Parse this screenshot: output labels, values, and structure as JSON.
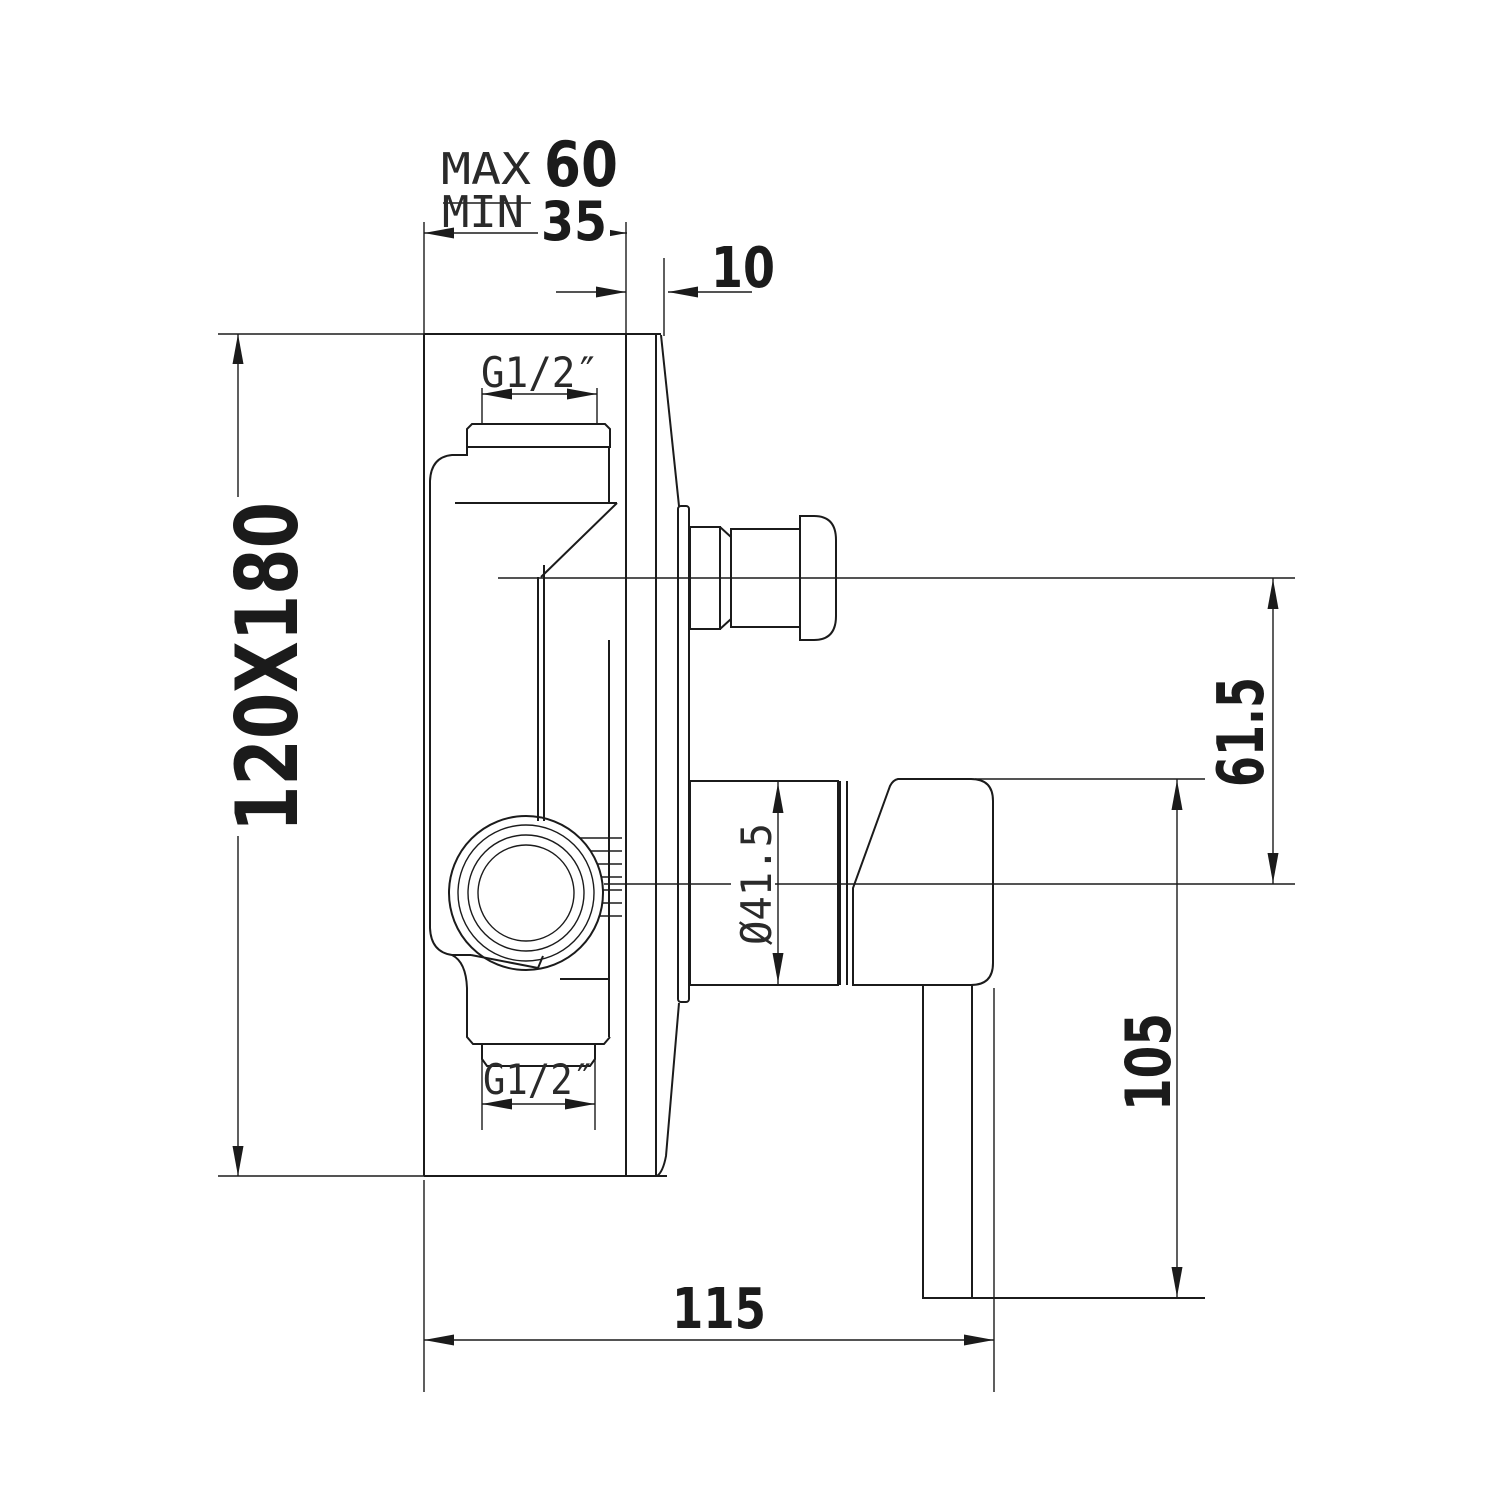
{
  "drawing": {
    "type": "technical-drawing",
    "subject": "concealed shower mixer valve side section",
    "colors": {
      "ink": "#1b1b1b",
      "background": "#ffffff"
    },
    "labels": {
      "max_label": "MAX",
      "max_value": "60",
      "min_label": "MIN",
      "min_value": "35",
      "plaster_depth": "10",
      "plate_size": "120X180",
      "thread_top": "G1/2″",
      "thread_bottom": "G1/2″",
      "outlet_offset": "61.5",
      "trim_diameter": "Ø41.5",
      "handle_drop": "105",
      "handle_reach": "115"
    }
  }
}
